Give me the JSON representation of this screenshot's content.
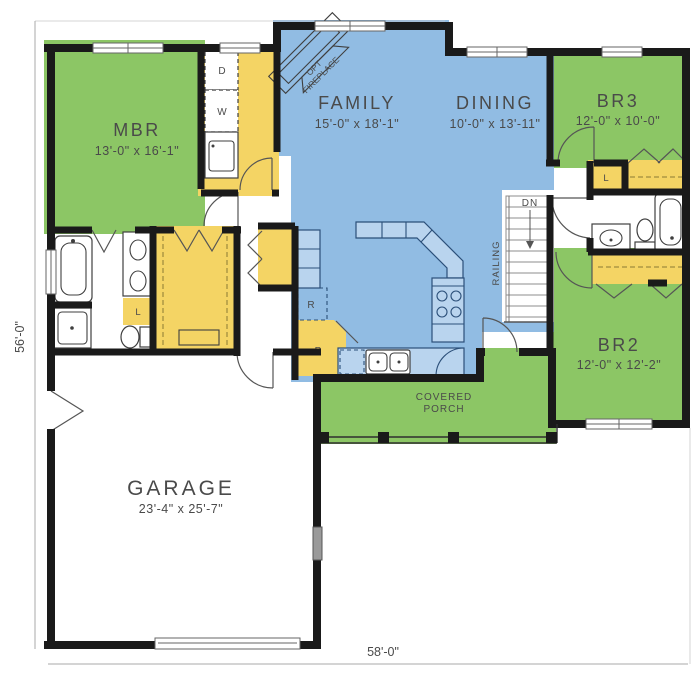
{
  "colors": {
    "bedroom_green": "#8cc665",
    "living_blue": "#91bce3",
    "closet_yellow": "#f4d464",
    "porch_green": "#8cc665",
    "wall_black": "#1a1a1a"
  },
  "dimensions": {
    "overall_width": "58'-0\"",
    "overall_depth": "56'-0\""
  },
  "rooms": {
    "mbr": {
      "name": "MBR",
      "dims": "13'-0\" x 16'-1\""
    },
    "family": {
      "name": "FAMILY",
      "dims": "15'-0\" x 18'-1\""
    },
    "dining": {
      "name": "DINING",
      "dims": "10'-0\" x 13'-11\""
    },
    "br3": {
      "name": "BR3",
      "dims": "12'-0\" x 10'-0\""
    },
    "br2": {
      "name": "BR2",
      "dims": "12'-0\" x 12'-2\""
    },
    "garage": {
      "name": "GARAGE",
      "dims": "23'-4\" x 25'-7\""
    },
    "porch": {
      "line1": "COVERED",
      "line2": "PORCH"
    }
  },
  "annotations": {
    "stairs_down": "DN",
    "railing": "RAILING",
    "fireplace_line1": "OPT",
    "fireplace_line2": "FIREPLACE",
    "dryer": "D",
    "washer": "W",
    "refrigerator": "R",
    "pantry": "P",
    "linen": "L"
  }
}
